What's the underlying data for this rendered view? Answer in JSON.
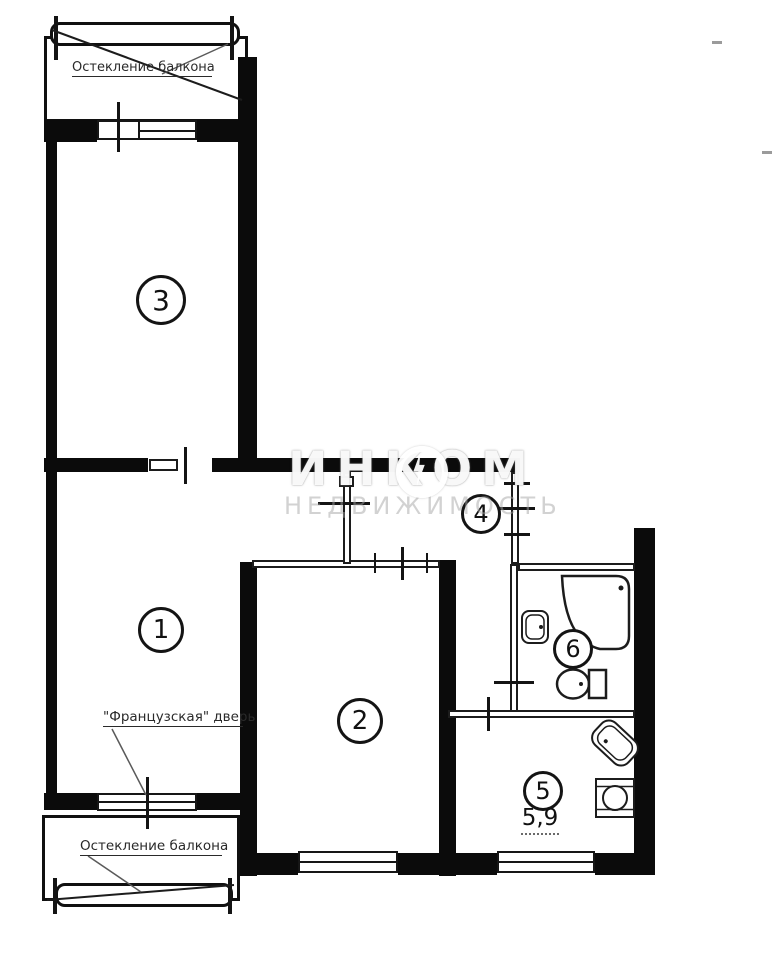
{
  "watermark": {
    "brand": "ИНКОМ",
    "subtitle": "НЕДВИЖИМОСТЬ"
  },
  "labels": {
    "balcony_top": "Остекление балкона",
    "balcony_bottom": "Остекление балкона",
    "french_door": "\"Французская\" дверь"
  },
  "rooms": [
    {
      "number": "1"
    },
    {
      "number": "2"
    },
    {
      "number": "3"
    },
    {
      "number": "4"
    },
    {
      "number": "5",
      "area": "5,9"
    },
    {
      "number": "6"
    }
  ],
  "colors": {
    "wall": "#0b0b0b",
    "line": "#1c1c1c",
    "watermark_brand": "#ffffff",
    "watermark_subtitle": "#a5a5a5",
    "background": "#ffffff"
  }
}
